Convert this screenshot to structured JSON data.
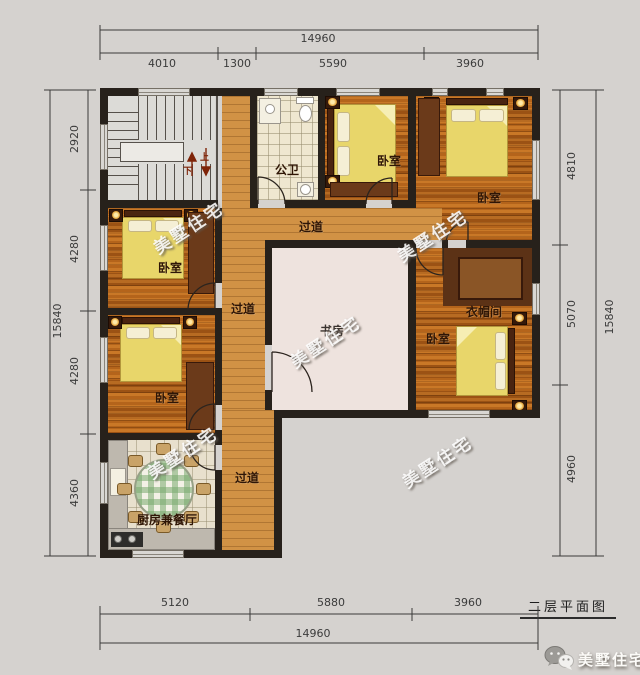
{
  "plan": {
    "title": "二层平面图",
    "brand": "美墅住宅",
    "rooms": {
      "bathroom": "公卫",
      "bedroom": "卧室",
      "study": "书房",
      "cloakroom": "衣帽间",
      "kitchen_dining": "厨房兼餐厅",
      "hallway": "过道",
      "up": "上",
      "down": "下"
    },
    "dimensions": {
      "top": {
        "total": "14960",
        "segments": [
          "4010",
          "1300",
          "5590",
          "3960"
        ]
      },
      "bottom": {
        "total": "14960",
        "segments": [
          "5120",
          "5880",
          "3960"
        ]
      },
      "left": {
        "total": "15840",
        "segments": [
          "2920",
          "4280",
          "4280",
          "4360"
        ]
      },
      "right": {
        "total": "15840",
        "segments": [
          "4810",
          "5070",
          "4960"
        ]
      }
    },
    "colors": {
      "background": "#d5d2cf",
      "wall": "#27211b",
      "hall_wood": "#d19245",
      "bedroom_wood": "#b4641b",
      "bed_blanket": "#e8d66a",
      "cloakroom_dark": "#5c3216"
    }
  }
}
